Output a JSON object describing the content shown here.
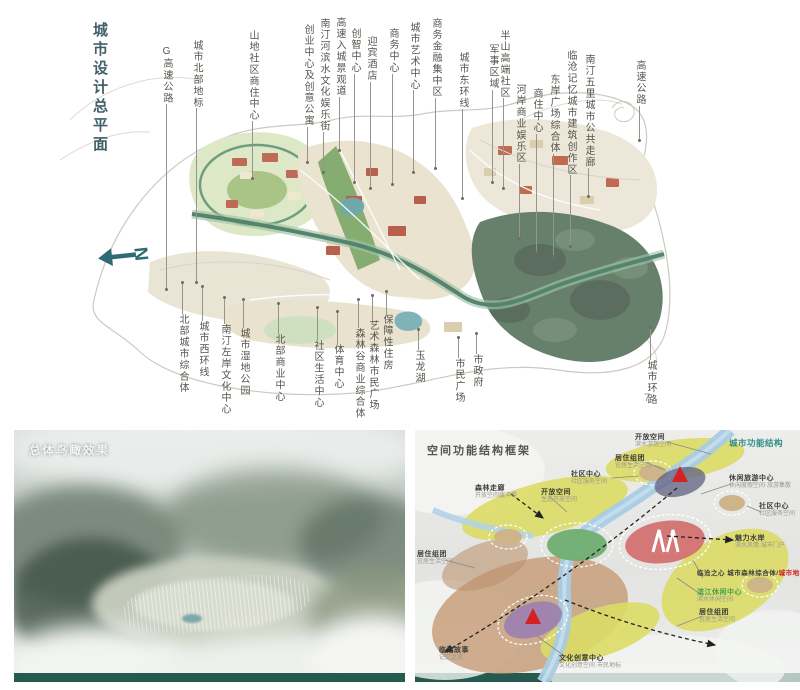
{
  "colors": {
    "plan_title": "#41606a",
    "north_arrow": "#2e6b74",
    "panel_bottom_bar": "#265a4e",
    "structure_header_teal": "#2f8c85",
    "landmark_red": "#cc2020",
    "riverside_green": "#3f9f4f",
    "forest": "#67806b",
    "river_corridor": "#55836d"
  },
  "master_plan": {
    "title": "城市设计总平面",
    "north_label": "N",
    "page_number": "7",
    "top_labels": [
      {
        "t": "G高速公路",
        "x": 160,
        "y": 46,
        "e": 288
      },
      {
        "t": "城市北部地标",
        "x": 190,
        "y": 40,
        "e": 282
      },
      {
        "t": "山地社区商住中心",
        "x": 246,
        "y": 30,
        "e": 178
      },
      {
        "t": "创业中心及创意公寓",
        "x": 301,
        "y": 24,
        "e": 162
      },
      {
        "t": "南汀河滨水文化娱乐街",
        "x": 317,
        "y": 18,
        "e": 172
      },
      {
        "t": "高速入城景观道",
        "x": 333,
        "y": 17,
        "e": 150
      },
      {
        "t": "创智中心",
        "x": 348,
        "y": 28,
        "e": 182
      },
      {
        "t": "迎宾酒店",
        "x": 364,
        "y": 36,
        "e": 188
      },
      {
        "t": "商务中心",
        "x": 386,
        "y": 28,
        "e": 184
      },
      {
        "t": "城市艺术中心",
        "x": 407,
        "y": 22,
        "e": 172
      },
      {
        "t": "商务金融集中区",
        "x": 429,
        "y": 18,
        "e": 168
      },
      {
        "t": "城市东环线",
        "x": 456,
        "y": 52,
        "e": 198
      },
      {
        "t": "军事区域",
        "x": 486,
        "y": 44,
        "e": 182
      },
      {
        "t": "半山高端社区",
        "x": 497,
        "y": 30,
        "e": 188
      },
      {
        "t": "河岸商业娱乐区",
        "x": 513,
        "y": 84,
        "e": 238
      },
      {
        "t": "商住中心",
        "x": 530,
        "y": 88,
        "e": 252
      },
      {
        "t": "东岸广场综合体",
        "x": 547,
        "y": 74,
        "e": 256
      },
      {
        "t": "临沧记忆城市建筑创作区",
        "x": 564,
        "y": 50,
        "e": 246
      },
      {
        "t": "南汀五里城市公共走廊",
        "x": 582,
        "y": 54,
        "e": 196
      },
      {
        "t": "高速公路",
        "x": 633,
        "y": 60,
        "e": 140
      }
    ],
    "bottom_labels": [
      {
        "t": "北部城市综合体",
        "x": 176,
        "s": 283,
        "y": 316
      },
      {
        "t": "城市西环线",
        "x": 196,
        "s": 287,
        "y": 323
      },
      {
        "t": "南汀左岸文化中心",
        "x": 218,
        "s": 298,
        "y": 326
      },
      {
        "t": "城市湿地公园",
        "x": 237,
        "s": 300,
        "y": 330
      },
      {
        "t": "北部商业中心",
        "x": 272,
        "s": 304,
        "y": 336
      },
      {
        "t": "社区生活中心",
        "x": 311,
        "s": 308,
        "y": 342
      },
      {
        "t": "体育中心",
        "x": 331,
        "s": 312,
        "y": 346
      },
      {
        "t": "森林谷商业综合体",
        "x": 352,
        "s": 300,
        "y": 330
      },
      {
        "t": "艺术森林市民广场",
        "x": 366,
        "s": 296,
        "y": 322
      },
      {
        "t": "保障性住房",
        "x": 380,
        "s": 292,
        "y": 316
      },
      {
        "t": "玉龙湖",
        "x": 412,
        "s": 330,
        "y": 352
      },
      {
        "t": "市民广场",
        "x": 452,
        "s": 338,
        "y": 360
      },
      {
        "t": "市政府",
        "x": 470,
        "s": 334,
        "y": 356
      },
      {
        "t": "城市环路",
        "x": 644,
        "s": 328,
        "y": 362
      }
    ]
  },
  "panels": {
    "aerial": {
      "title": "总体鸟瞰效果"
    },
    "structure": {
      "title": "空间功能结构框架",
      "labels": [
        {
          "t": "开放空间",
          "sub": "滨水游憩空间",
          "x": 220,
          "y": 3
        },
        {
          "t": "城市功能结构",
          "x": 314,
          "y": 8,
          "cls": "teal"
        },
        {
          "t": "居住组团",
          "sub": "宜居生活空间",
          "x": 200,
          "y": 24
        },
        {
          "t": "社区中心",
          "sub": "社区服务空间",
          "x": 156,
          "y": 40
        },
        {
          "t": "休闲旅游中心",
          "sub": "休闲度假空间·旅游集散",
          "x": 314,
          "y": 44
        },
        {
          "t": "社区中心",
          "sub": "社区服务空间",
          "x": 344,
          "y": 72
        },
        {
          "t": "森林走廊",
          "sub": "开放空间缓冲带",
          "x": 60,
          "y": 54
        },
        {
          "t": "开放空间",
          "sub": "生态开放空间",
          "x": 126,
          "y": 58
        },
        {
          "t": "居住组团",
          "sub": "宜居生活空间",
          "x": 2,
          "y": 120
        },
        {
          "t": "魅力水岸",
          "sub": "滨水风情·城市门户",
          "x": 320,
          "y": 104
        },
        {
          "t": "临沧之心 城市森林综合体/",
          "t2": "城市地标",
          "x": 282,
          "y": 140,
          "cls": "long"
        },
        {
          "t": "滨江休闲中心",
          "sub": "滨水休闲空间",
          "x": 282,
          "y": 158,
          "cls": "green"
        },
        {
          "t": "居住组团",
          "sub": "宜居生活空间",
          "x": 284,
          "y": 178
        },
        {
          "t": "临沧故事",
          "sub": "记忆之旅",
          "x": 24,
          "y": 216
        },
        {
          "t": "文化创意中心",
          "sub": "文化创意空间·市民地标",
          "x": 144,
          "y": 224
        }
      ]
    }
  }
}
